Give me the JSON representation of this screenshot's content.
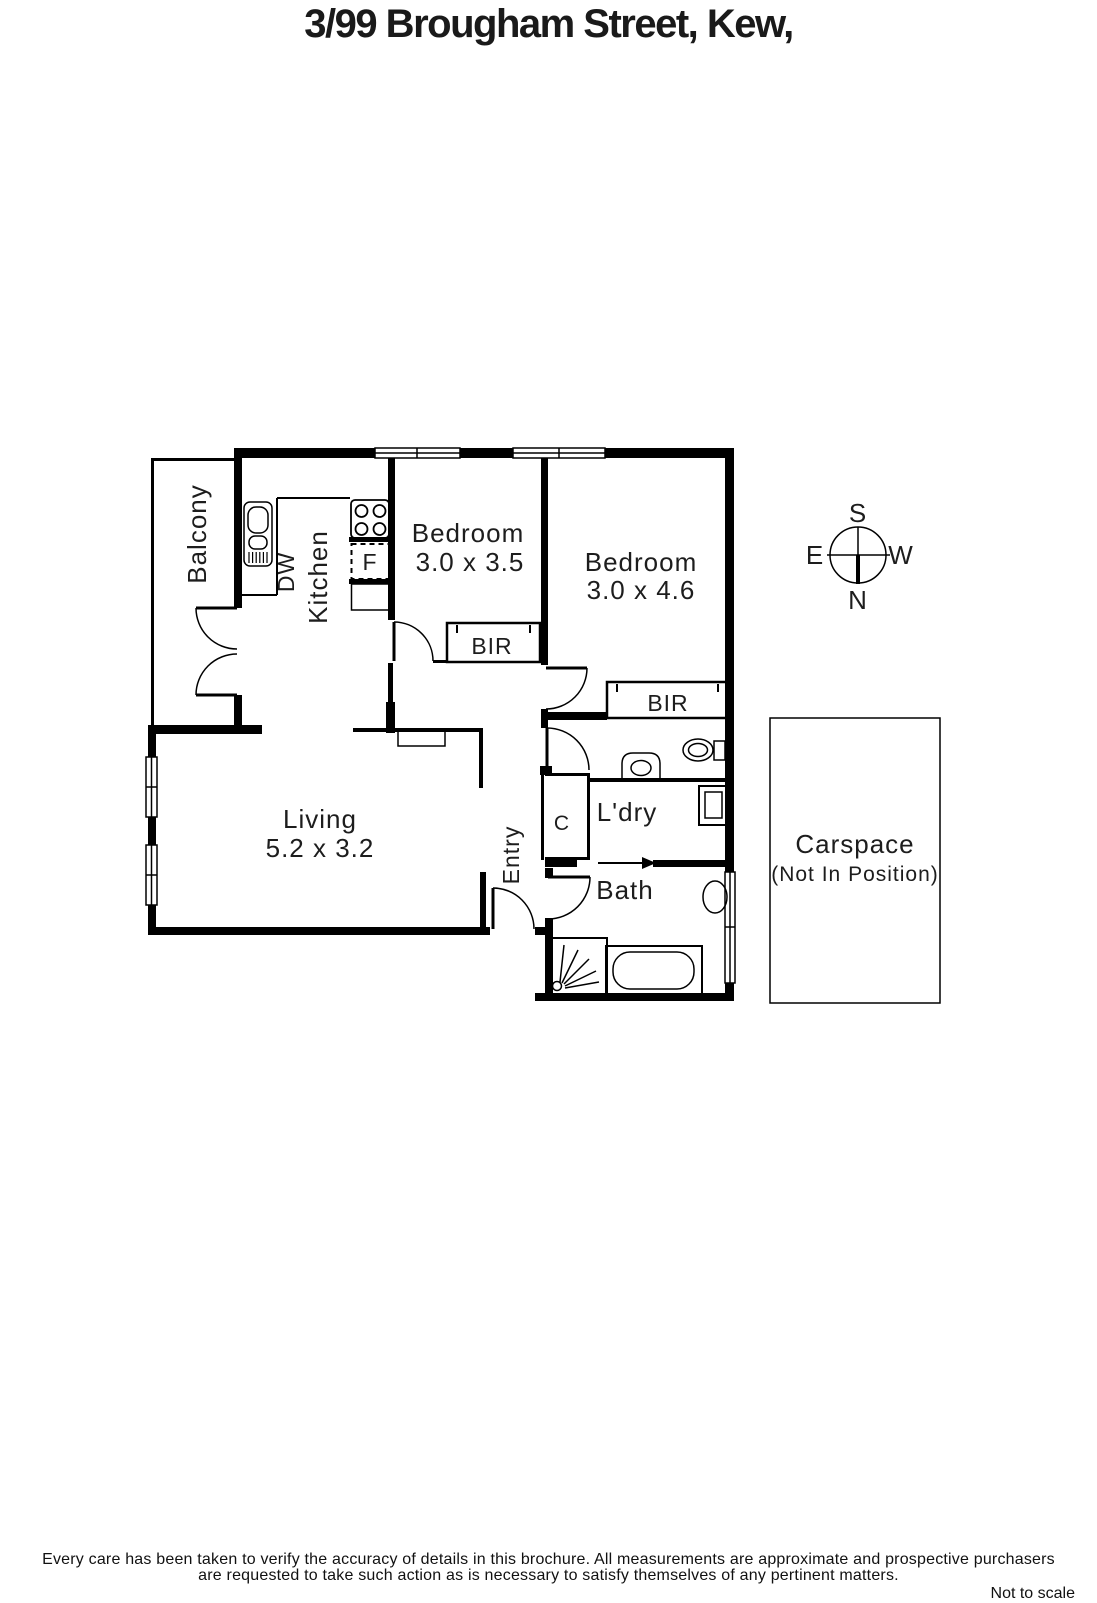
{
  "title": "3/99 Brougham Street, Kew,",
  "rooms": {
    "balcony": {
      "label": "Balcony"
    },
    "kitchen": {
      "label": "Kitchen"
    },
    "dishwasher": {
      "label": "DW"
    },
    "fridge": {
      "label": "F"
    },
    "bedroom1": {
      "label": "Bedroom",
      "dims": "3.0 x 3.5"
    },
    "bedroom2": {
      "label": "Bedroom",
      "dims": "3.0 x 4.6"
    },
    "bir1": {
      "label": "BIR"
    },
    "bir2": {
      "label": "BIR"
    },
    "living": {
      "label": "Living",
      "dims": "5.2 x 3.2"
    },
    "entry": {
      "label": "Entry"
    },
    "cupboard": {
      "label": "C"
    },
    "laundry": {
      "label": "L'dry"
    },
    "bath": {
      "label": "Bath"
    },
    "carspace": {
      "label": "Carspace",
      "note": "(Not In Position)"
    }
  },
  "compass": {
    "south": "S",
    "north": "N",
    "east": "E",
    "west": "W"
  },
  "footer": {
    "line1": "Every care has been taken to verify the accuracy of details in this brochure.  All measurements are approximate and prospective purchasers",
    "line2": "are requested to take such action as is necessary to satisfy themselves of any pertinent matters.",
    "scale_note": "Not to scale"
  },
  "colors": {
    "line": "#000000",
    "text": "#1d1d1d",
    "background": "#ffffff"
  }
}
